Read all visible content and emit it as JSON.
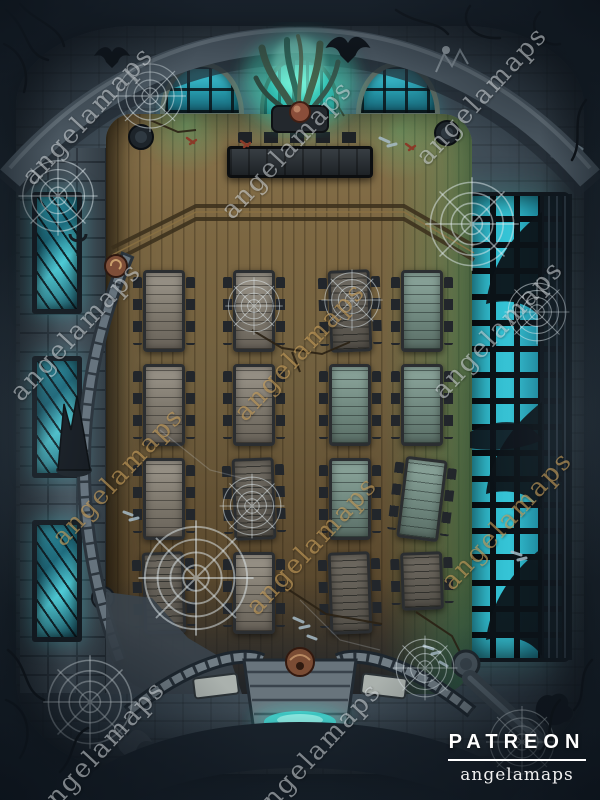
{
  "branding": {
    "patreon_label": "PATREON",
    "author_label": "angelamaps"
  },
  "watermark": {
    "text": "angelamaps"
  },
  "palette": {
    "mist": "#1d2731",
    "stone": "#3e4b55",
    "stone_dark": "#242e38",
    "wood": "#71603f",
    "wood_dark": "#483a25",
    "glass": "#2fb9cc",
    "glass_deep": "#15505f",
    "glow": "#49e4cf",
    "green_glow": "#3f9e6a",
    "table": "#8f897e",
    "stool": "#22262b",
    "web": "#dfe9ee",
    "watermark_white": "rgba(236,242,246,0.5)",
    "watermark_gold": "rgba(206,165,96,0.62)"
  },
  "decor_icons": [
    "gargoyle-icon",
    "bat-icon",
    "skeletal-bat-icon",
    "spider-web-icon",
    "thorn-branches-icon",
    "organ-tentacles-icon",
    "rosette-icon",
    "gargoyle-face-icon",
    "shell-ornament-icon",
    "statue-icon",
    "bones-icon",
    "candle-mark-icon"
  ]
}
